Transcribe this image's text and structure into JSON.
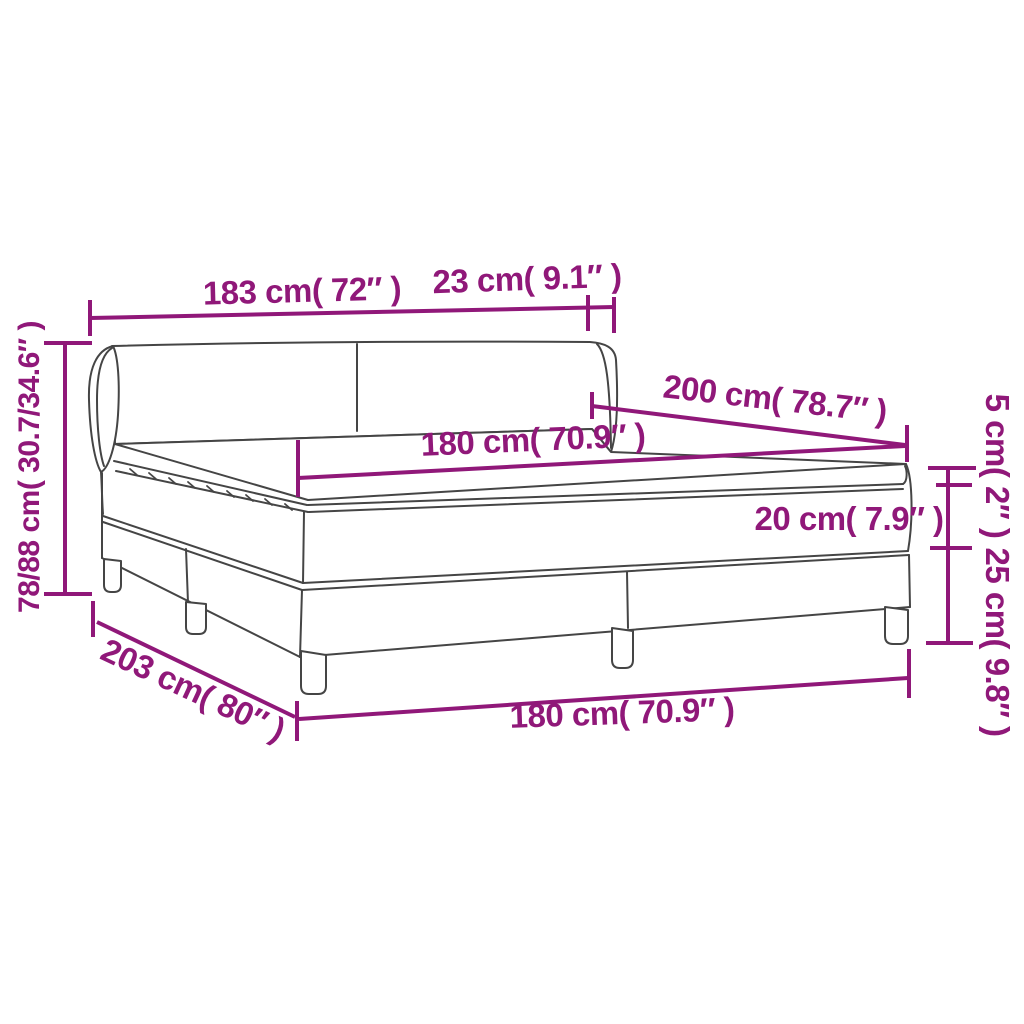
{
  "diagram": {
    "kind": "bed-dimension-diagram",
    "colors": {
      "accent": "#901879",
      "line": "#454545",
      "background": "#ffffff"
    },
    "labels": {
      "headboard_width": "183 cm( 72″ )",
      "wing_depth": "23 cm( 9.1″ )",
      "height_range": "78/88 cm( 30.7/34.6″ )",
      "mattress_length": "200 cm( 78.7″ )",
      "mattress_width_top": "180 cm( 70.9″ )",
      "topper_height": "5 cm( 2″ )",
      "mattress_height": "20 cm( 7.9″ )",
      "base_height": "25 cm( 9.8″ )",
      "total_length": "203 cm( 80″ )",
      "base_width_bottom": "180 cm( 70.9″ )"
    }
  }
}
